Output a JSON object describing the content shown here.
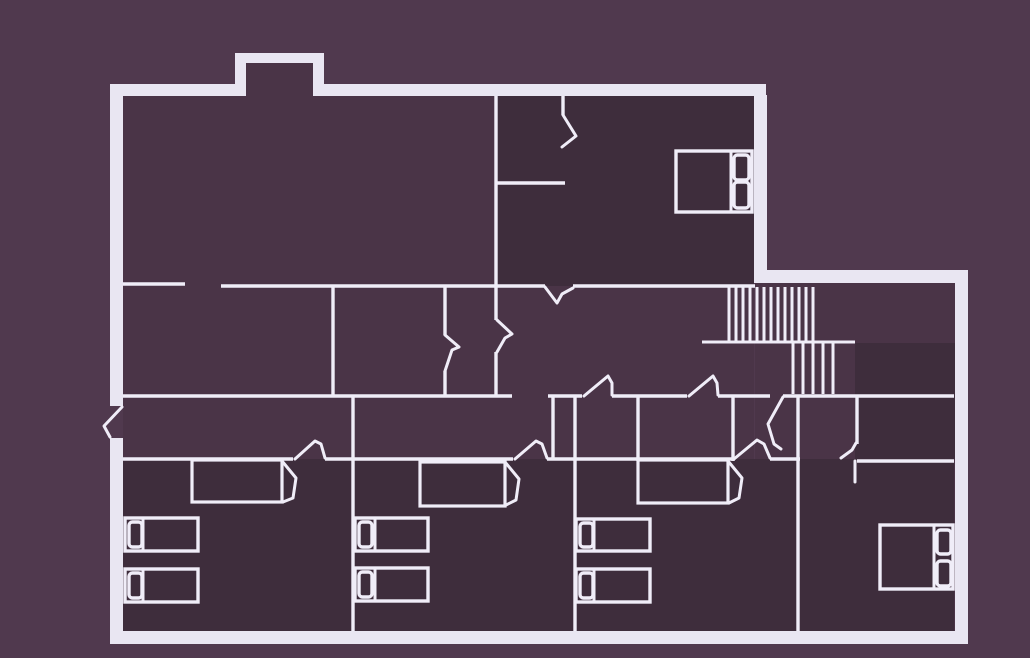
{
  "colors": {
    "outside": "#50394e",
    "interior": "#4a3447",
    "room_dark": "#3e2d3c",
    "wall": "#e9e6f2",
    "line": "#f0edf8"
  },
  "floorplan": {
    "interior_areas": [
      [
        123,
        96,
        631,
        535
      ],
      [
        755,
        283,
        200,
        348
      ],
      [
        245,
        55,
        69,
        43
      ]
    ],
    "dark_rooms": [
      [
        497,
        96,
        257,
        190
      ],
      [
        123,
        459,
        831,
        172
      ],
      [
        855,
        343,
        100,
        116
      ]
    ],
    "outer_walls": [
      [
        110,
        84,
        135,
        12
      ],
      [
        313,
        84,
        453,
        12
      ],
      [
        235,
        53,
        11,
        43
      ],
      [
        235,
        53,
        89,
        10
      ],
      [
        313,
        53,
        11,
        43
      ],
      [
        110,
        84,
        13,
        322
      ],
      [
        110,
        438,
        13,
        206
      ],
      [
        110,
        631,
        858,
        13
      ],
      [
        754,
        95,
        13,
        186
      ],
      [
        754,
        270,
        214,
        13
      ],
      [
        955,
        270,
        13,
        374
      ]
    ],
    "inner_walls": [
      [
        123,
        284,
        185,
        284
      ],
      [
        221,
        286,
        545,
        286
      ],
      [
        573,
        286,
        755,
        286
      ],
      [
        497,
        183,
        565,
        183
      ],
      [
        123,
        396,
        512,
        396
      ],
      [
        548,
        396,
        582,
        396
      ],
      [
        612,
        396,
        687,
        396
      ],
      [
        718,
        396,
        770,
        396
      ],
      [
        783,
        396,
        954,
        396
      ],
      [
        123,
        459,
        293,
        459
      ],
      [
        325,
        459,
        513,
        459
      ],
      [
        547,
        459,
        732,
        459
      ],
      [
        770,
        459,
        800,
        459
      ],
      [
        857,
        461,
        954,
        461
      ],
      [
        333,
        286,
        333,
        397
      ],
      [
        445,
        286,
        445,
        335
      ],
      [
        445,
        371,
        445,
        397
      ],
      [
        496,
        96,
        496,
        320
      ],
      [
        496,
        352,
        496,
        397
      ],
      [
        563,
        96,
        563,
        115
      ],
      [
        553,
        396,
        553,
        459
      ],
      [
        575,
        396,
        575,
        631
      ],
      [
        638,
        396,
        638,
        461
      ],
      [
        733,
        396,
        733,
        461
      ],
      [
        798,
        396,
        798,
        631
      ],
      [
        857,
        396,
        857,
        444
      ],
      [
        353,
        396,
        353,
        631
      ]
    ],
    "stairs": {
      "flights": [
        {
          "x_start": 729,
          "x_end": 813,
          "count": 13,
          "y_top": 287,
          "y_bottom": 341
        },
        {
          "x_start": 793,
          "x_end": 833,
          "count": 5,
          "y_top": 343,
          "y_bottom": 394
        }
      ],
      "rail": [
        702,
        342,
        855,
        342
      ]
    },
    "doors": [
      {
        "name": "entry-door-swing",
        "lines": [
          [
            [
              122,
              407
            ],
            [
              104,
              426
            ],
            [
              110,
              437
            ]
          ]
        ]
      },
      {
        "name": "closet-nook-door-swing",
        "lines": [
          [
            [
              563,
              115
            ],
            [
              576,
              136
            ],
            [
              562,
              147
            ]
          ]
        ]
      },
      {
        "name": "hall-door-swing",
        "lines": [
          [
            [
              545,
              287
            ],
            [
              557,
              303
            ],
            [
              562,
              294
            ],
            [
              573,
              288
            ]
          ]
        ]
      },
      {
        "name": "vestibule-door-swing",
        "lines": [
          [
            [
              497,
              320
            ],
            [
              512,
              334
            ],
            [
              505,
              338
            ],
            [
              497,
              352
            ]
          ]
        ]
      },
      {
        "name": "room-door-swing",
        "lines": [
          [
            [
              445,
              335
            ],
            [
              459,
              347
            ],
            [
              452,
              350
            ],
            [
              445,
              371
            ]
          ]
        ]
      },
      {
        "name": "hall-door-swing",
        "lines": [
          [
            [
              584,
              396
            ],
            [
              608,
              376
            ],
            [
              612,
              383
            ],
            [
              612,
              395
            ]
          ]
        ]
      },
      {
        "name": "hall-door-swing",
        "lines": [
          [
            [
              689,
              396
            ],
            [
              713,
              376
            ],
            [
              717,
              383
            ],
            [
              718,
              395
            ]
          ]
        ]
      },
      {
        "name": "bedroom-door-swing",
        "lines": [
          [
            [
              295,
              459
            ],
            [
              315,
              441
            ],
            [
              321,
              444
            ],
            [
              325,
              458
            ]
          ]
        ]
      },
      {
        "name": "bedroom-door-swing",
        "lines": [
          [
            [
              515,
              459
            ],
            [
              536,
              441
            ],
            [
              542,
              444
            ],
            [
              547,
              458
            ]
          ]
        ]
      },
      {
        "name": "bedroom-door-swing",
        "lines": [
          [
            [
              734,
              459
            ],
            [
              757,
              440
            ],
            [
              764,
              444
            ],
            [
              770,
              458
            ]
          ]
        ]
      },
      {
        "name": "landing-door-swing",
        "lines": [
          [
            [
              783,
              397
            ],
            [
              768,
              424
            ],
            [
              774,
              444
            ],
            [
              781,
              449
            ]
          ]
        ]
      },
      {
        "name": "landing-door-swing",
        "lines": [
          [
            [
              841,
              458
            ],
            [
              852,
              450
            ],
            [
              856,
              443
            ]
          ],
          [
            [
              855,
              461
            ],
            [
              855,
              482
            ]
          ]
        ]
      }
    ],
    "closets": [
      {
        "rect": [
          192,
          460,
          90,
          42
        ],
        "leaf": [
          [
            282,
            461
          ],
          [
            296,
            478
          ],
          [
            293,
            498
          ],
          [
            283,
            502
          ]
        ]
      },
      {
        "rect": [
          420,
          462,
          85,
          44
        ],
        "leaf": [
          [
            505,
            462
          ],
          [
            519,
            479
          ],
          [
            516,
            500
          ],
          [
            506,
            505
          ]
        ]
      },
      {
        "rect": [
          638,
          460,
          90,
          43
        ],
        "leaf": [
          [
            728,
            461
          ],
          [
            742,
            478
          ],
          [
            739,
            498
          ],
          [
            729,
            503
          ]
        ]
      }
    ],
    "beds": [
      {
        "rect": [
          676,
          151,
          76,
          61
        ],
        "divider_x": 731,
        "pillows": [
          [
            734,
            155,
            15,
            25
          ],
          [
            734,
            182,
            15,
            26
          ]
        ]
      },
      {
        "rect": [
          880,
          525,
          73,
          64
        ],
        "divider_x": 934,
        "pillows": [
          [
            937,
            530,
            14,
            24
          ],
          [
            937,
            561,
            14,
            25
          ]
        ]
      },
      {
        "rect": [
          125,
          518,
          73,
          33
        ],
        "divider_x": 143,
        "pillows": [
          [
            129,
            522,
            13,
            25
          ]
        ]
      },
      {
        "rect": [
          125,
          569,
          73,
          33
        ],
        "divider_x": 143,
        "pillows": [
          [
            129,
            573,
            13,
            25
          ]
        ]
      },
      {
        "rect": [
          355,
          518,
          73,
          33
        ],
        "divider_x": 375,
        "pillows": [
          [
            359,
            522,
            13,
            25
          ]
        ]
      },
      {
        "rect": [
          355,
          568,
          73,
          33
        ],
        "divider_x": 375,
        "pillows": [
          [
            359,
            572,
            13,
            25
          ]
        ]
      },
      {
        "rect": [
          576,
          519,
          74,
          32
        ],
        "divider_x": 594,
        "pillows": [
          [
            580,
            523,
            13,
            24
          ]
        ]
      },
      {
        "rect": [
          576,
          569,
          74,
          33
        ],
        "divider_x": 594,
        "pillows": [
          [
            580,
            573,
            13,
            25
          ]
        ]
      }
    ]
  }
}
